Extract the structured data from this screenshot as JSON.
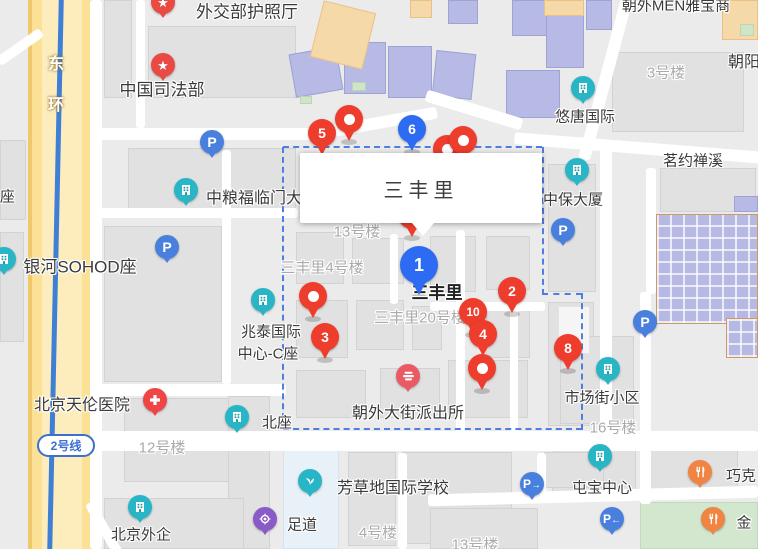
{
  "info_box": {
    "title": "三丰里"
  },
  "road": {
    "metro_badge": "2号线"
  },
  "labels": [
    {
      "name": "poi-label",
      "text": "外交部护照厅",
      "x": 247,
      "y": 10,
      "style": "dark",
      "size": 17
    },
    {
      "name": "poi-label",
      "text": "中国司法部",
      "x": 162,
      "y": 88,
      "style": "dark",
      "size": 17
    },
    {
      "name": "poi-label",
      "text": "朝外MEN雅宝商",
      "x": 676,
      "y": 5,
      "style": "dark",
      "size": 15
    },
    {
      "name": "district-label",
      "text": "朝阳",
      "x": 744,
      "y": 60,
      "style": "dark",
      "size": 16
    },
    {
      "name": "poi-label",
      "text": "悠唐国际",
      "x": 585,
      "y": 116,
      "style": "dark",
      "size": 15
    },
    {
      "name": "poi-label",
      "text": "茗约禅溪",
      "x": 693,
      "y": 160,
      "style": "dark",
      "size": 15
    },
    {
      "name": "poi-label",
      "text": "中保大厦",
      "x": 573,
      "y": 199,
      "style": "dark",
      "size": 15
    },
    {
      "name": "poi-label",
      "text": "中粮福临门大厦",
      "x": 262,
      "y": 196,
      "style": "dark",
      "size": 16
    },
    {
      "name": "poi-label",
      "text": "银河SOHOD座",
      "x": 80,
      "y": 265,
      "style": "dark",
      "size": 17
    },
    {
      "name": "poi-label",
      "text": "兆泰国际",
      "x": 271,
      "y": 331,
      "style": "dark",
      "size": 15
    },
    {
      "name": "poi-label",
      "text": "中心-C座",
      "x": 268,
      "y": 353,
      "style": "dark",
      "size": 15
    },
    {
      "name": "area-label",
      "text": "三丰里",
      "x": 437,
      "y": 291,
      "style": "area",
      "size": 17
    },
    {
      "name": "poi-label",
      "text": "北京天伦医院",
      "x": 82,
      "y": 403,
      "style": "dark",
      "size": 16
    },
    {
      "name": "poi-label",
      "text": "北座",
      "x": 277,
      "y": 422,
      "style": "dark",
      "size": 15
    },
    {
      "name": "poi-label",
      "text": "朝外大街派出所",
      "x": 408,
      "y": 411,
      "style": "dark",
      "size": 16
    },
    {
      "name": "poi-label",
      "text": "市场街小区",
      "x": 602,
      "y": 397,
      "style": "dark",
      "size": 15
    },
    {
      "name": "poi-label",
      "text": "屯宝中心",
      "x": 602,
      "y": 487,
      "style": "dark",
      "size": 15
    },
    {
      "name": "poi-label",
      "text": "芳草地国际学校",
      "x": 393,
      "y": 486,
      "style": "dark",
      "size": 16
    },
    {
      "name": "poi-label",
      "text": "足道",
      "x": 302,
      "y": 524,
      "style": "dark",
      "size": 15
    },
    {
      "name": "poi-label",
      "text": "北京外企",
      "x": 141,
      "y": 534,
      "style": "dark",
      "size": 15
    },
    {
      "name": "poi-label",
      "text": "巧克",
      "x": 741,
      "y": 475,
      "style": "dark",
      "size": 15
    },
    {
      "name": "poi-label",
      "text": "金",
      "x": 744,
      "y": 522,
      "style": "dark",
      "size": 15
    },
    {
      "name": "poi-label",
      "text": "C座",
      "x": 2,
      "y": 196,
      "style": "dark",
      "size": 15
    },
    {
      "name": "building-label",
      "text": "3号楼",
      "x": 666,
      "y": 72,
      "style": "grey",
      "size": 15
    },
    {
      "name": "building-label",
      "text": "13号楼",
      "x": 357,
      "y": 231,
      "style": "grey",
      "size": 15
    },
    {
      "name": "building-label",
      "text": "三丰里4号楼",
      "x": 322,
      "y": 267,
      "style": "grey",
      "size": 15
    },
    {
      "name": "building-label",
      "text": "三丰里20号楼",
      "x": 420,
      "y": 317,
      "style": "grey",
      "size": 15
    },
    {
      "name": "building-label",
      "text": "12号楼",
      "x": 162,
      "y": 447,
      "style": "grey",
      "size": 15
    },
    {
      "name": "building-label",
      "text": "16号楼",
      "x": 613,
      "y": 427,
      "style": "grey",
      "size": 15
    },
    {
      "name": "building-label",
      "text": "4号楼",
      "x": 378,
      "y": 532,
      "style": "grey",
      "size": 15
    },
    {
      "name": "building-label",
      "text": "13号楼",
      "x": 475,
      "y": 544,
      "style": "grey",
      "size": 15
    },
    {
      "name": "road-name-char",
      "text": "东",
      "x": 56,
      "y": 62,
      "style": "road",
      "size": 16
    },
    {
      "name": "road-name-char",
      "text": "环",
      "x": 56,
      "y": 103,
      "style": "road",
      "size": 16
    }
  ],
  "pins": [
    {
      "label": "5",
      "color": "red",
      "x": 322,
      "y": 156
    },
    {
      "label": "",
      "dot": true,
      "color": "red",
      "x": 349,
      "y": 142
    },
    {
      "label": "6",
      "color": "blue",
      "x": 412,
      "y": 152
    },
    {
      "label": "",
      "dot": true,
      "color": "red",
      "x": 447,
      "y": 172
    },
    {
      "label": "",
      "dot": true,
      "color": "red",
      "x": 463,
      "y": 163
    },
    {
      "label": "",
      "dot": true,
      "color": "red",
      "x": 412,
      "y": 238
    },
    {
      "label": "2",
      "color": "red",
      "x": 512,
      "y": 314
    },
    {
      "label": "10",
      "color": "red",
      "x": 473,
      "y": 335
    },
    {
      "label": "4",
      "color": "red",
      "x": 483,
      "y": 357
    },
    {
      "label": "",
      "dot": true,
      "color": "red",
      "x": 482,
      "y": 391
    },
    {
      "label": "8",
      "color": "red",
      "x": 568,
      "y": 371
    },
    {
      "label": "",
      "dot": true,
      "color": "red",
      "x": 313,
      "y": 319
    },
    {
      "label": "3",
      "color": "red",
      "x": 325,
      "y": 360
    },
    {
      "label": "1",
      "color": "blue",
      "big": true,
      "x": 419,
      "y": 297
    }
  ],
  "poi_markers": [
    {
      "name": "star-marker",
      "icon": "star",
      "color": "red",
      "x": 163,
      "y": 2
    },
    {
      "name": "star-marker",
      "icon": "star",
      "color": "red",
      "x": 163,
      "y": 65
    },
    {
      "name": "parking-marker",
      "icon": "p",
      "color": "blue",
      "x": 212,
      "y": 142
    },
    {
      "name": "parking-marker",
      "icon": "p",
      "color": "blue",
      "x": 167,
      "y": 247
    },
    {
      "name": "parking-marker",
      "icon": "p",
      "color": "blue",
      "x": 563,
      "y": 230
    },
    {
      "name": "parking-marker",
      "icon": "p",
      "color": "blue",
      "x": 645,
      "y": 322
    },
    {
      "name": "parking-entrance-marker",
      "icon": "p-right",
      "color": "blue",
      "x": 532,
      "y": 484
    },
    {
      "name": "parking-entrance-marker",
      "icon": "p-left",
      "color": "blue",
      "x": 612,
      "y": 519
    },
    {
      "name": "building-marker",
      "icon": "building",
      "color": "teal",
      "x": 186,
      "y": 190
    },
    {
      "name": "building-marker",
      "icon": "building",
      "color": "teal",
      "x": 4,
      "y": 259
    },
    {
      "name": "building-marker",
      "icon": "building",
      "color": "teal",
      "x": 583,
      "y": 88
    },
    {
      "name": "building-marker",
      "icon": "building",
      "color": "teal",
      "x": 577,
      "y": 170
    },
    {
      "name": "building-marker",
      "icon": "building",
      "color": "teal",
      "x": 263,
      "y": 300
    },
    {
      "name": "building-marker",
      "icon": "building",
      "color": "teal",
      "x": 237,
      "y": 417
    },
    {
      "name": "building-marker",
      "icon": "building",
      "color": "teal",
      "x": 608,
      "y": 369
    },
    {
      "name": "building-marker",
      "icon": "building",
      "color": "teal",
      "x": 600,
      "y": 456
    },
    {
      "name": "building-marker",
      "icon": "building",
      "color": "teal",
      "x": 140,
      "y": 507
    },
    {
      "name": "school-marker",
      "icon": "leaf",
      "color": "teal",
      "x": 310,
      "y": 481
    },
    {
      "name": "foot-massage-marker",
      "icon": "gear",
      "color": "purple",
      "x": 265,
      "y": 519
    },
    {
      "name": "police-marker",
      "icon": "police",
      "color": "pink",
      "x": 408,
      "y": 376
    },
    {
      "name": "hospital-marker",
      "icon": "cross",
      "color": "red2",
      "x": 155,
      "y": 400
    },
    {
      "name": "restaurant-marker",
      "icon": "fork",
      "color": "orange",
      "x": 700,
      "y": 472
    },
    {
      "name": "restaurant-marker",
      "icon": "fork",
      "color": "orange",
      "x": 713,
      "y": 519
    }
  ],
  "colors": {
    "selected_pin": "#2c6bf2",
    "result_pin": "#ee3d2c",
    "boundary": "#4f7de0",
    "metro_line": "#3f7fd6"
  }
}
